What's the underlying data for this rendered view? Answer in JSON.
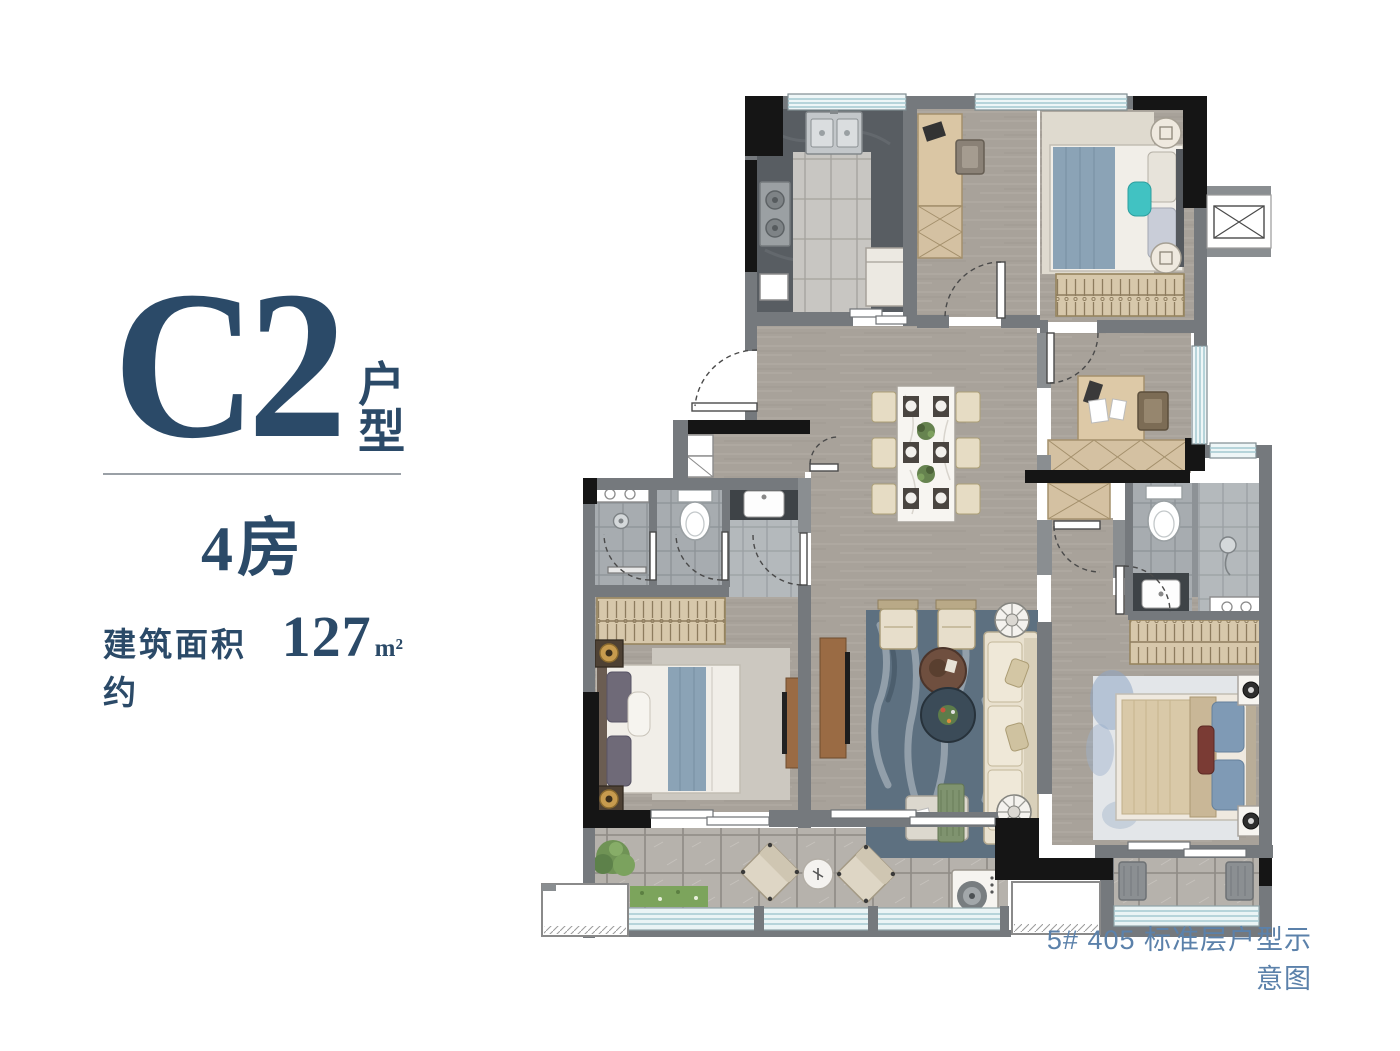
{
  "panel": {
    "title": "C2",
    "title_suffix": "户型",
    "subtitle": "4房",
    "area_label": "建筑面积约",
    "area_value": "127",
    "area_unit": "m²"
  },
  "caption": "5# 405 标准层户型示意图",
  "colors": {
    "title_navy": "#2b4a68",
    "caption_blue": "#5b81aa",
    "wall_gray": "#75797d",
    "wall_black": "#151515",
    "window_teal": "#a4c9d1",
    "wood_floor": "#a8a29a",
    "accent_teal": "#41c2c2"
  }
}
